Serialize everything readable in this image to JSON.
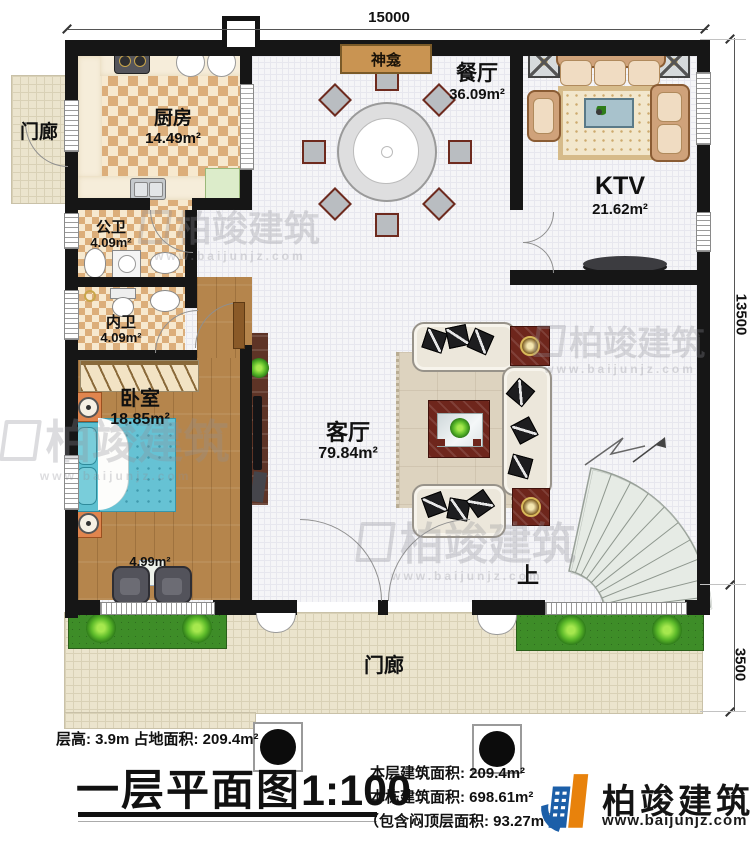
{
  "plan": {
    "dim_top": "15000",
    "dim_right_main": "13500",
    "dim_right_porch": "3500",
    "rooms": {
      "kitchen": {
        "name": "厨房",
        "area": "14.49m²"
      },
      "public_bath": {
        "name": "公卫",
        "area": "4.09m²"
      },
      "private_bath": {
        "name": "内卫",
        "area": "4.09m²"
      },
      "bedroom": {
        "name": "卧室",
        "area": "18.85m²"
      },
      "bedroom_bay": {
        "area": "4.99m²"
      },
      "living_room": {
        "name": "客厅",
        "area": "79.84m²"
      },
      "dining_room": {
        "name": "餐厅",
        "area": "36.09m²"
      },
      "ktv": {
        "name": "KTV",
        "area": "21.62m²"
      },
      "shrine": {
        "name": "神龛"
      },
      "porch_left": {
        "name": "门廊"
      },
      "porch_front": {
        "name": "门廊"
      },
      "stair_up": {
        "name": "上"
      }
    },
    "footer": {
      "floor_info": "层高: 3.9m  占地面积: 209.4m²",
      "title": "一层平面图",
      "scale": "1:100",
      "area_current": "本层建筑面积: 209.4m²",
      "area_total": "本栋建筑面积: 698.61m²",
      "area_attic": "（包含闷顶层面积: 93.27m²）"
    },
    "brand": {
      "name": "柏竣建筑",
      "url": "www.baijunjz.com"
    },
    "watermark": {
      "name": "柏竣建筑",
      "url": "www.baijunjz.com"
    },
    "colors": {
      "wall": "#161616",
      "checker_tile": "#dcae7a",
      "wood_floor": "#b5854c",
      "porch_floor": "#ebe4cd",
      "grass": "#3e8d28",
      "bed": "#62bed2",
      "dark_table": "#6e261c",
      "logo_blue": "#1c5fa8",
      "logo_orange": "#e8820c"
    }
  }
}
